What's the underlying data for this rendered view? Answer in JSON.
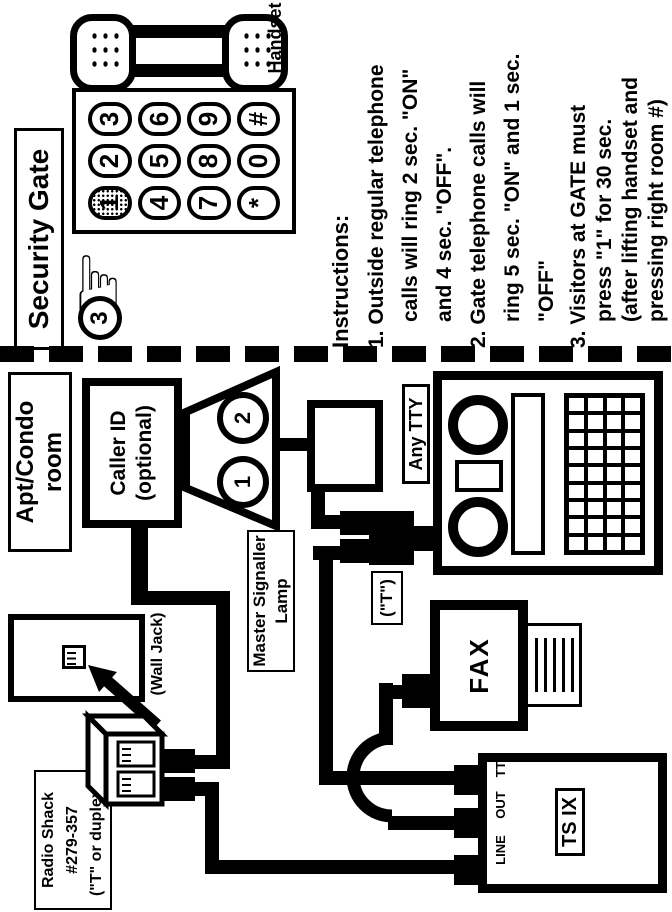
{
  "colors": {
    "ink": "#000000",
    "paper": "#ffffff"
  },
  "gate": {
    "title": "Security Gate",
    "handset_label": "Handset",
    "hand_glyph": "☞",
    "step_badge": "3",
    "keypad_keys": [
      "1",
      "2",
      "3",
      "4",
      "5",
      "6",
      "7",
      "8",
      "9",
      "*",
      "0",
      "#"
    ],
    "instructions": {
      "heading": "Instructions:",
      "items": [
        {
          "lines": [
            "1. Outside regular telephone",
            "calls will ring 2 sec. \"ON\"",
            "and 4 sec. \"OFF\"."
          ]
        },
        {
          "lines": [
            "2. Gate telephone calls will",
            "ring 5 sec. \"ON\" and 1 sec.",
            "\"OFF\""
          ]
        },
        {
          "lines": [
            "3. Visitors at GATE must",
            "press \"1\" for 30 sec.",
            "(after lifting handset and",
            "pressing right room #)"
          ]
        }
      ]
    }
  },
  "room": {
    "title": [
      "Apt/Condo",
      "room"
    ],
    "caller_id": [
      "Caller ID",
      "(optional)"
    ],
    "lamp_circles": [
      "1",
      "2"
    ],
    "master_signaller_label": [
      "Master Signaller",
      "Lamp"
    ],
    "t_label": "(\"T\")",
    "any_tty": "Any TTY",
    "wall_jack": "(Wall Jack)",
    "radio_shack": [
      "Radio Shack",
      "#279-357",
      "(\"T\" or duplex)"
    ],
    "fax": "FAX",
    "tsix": "TS IX",
    "tsix_jacks": [
      "LINE",
      "OUT",
      "TTY"
    ]
  }
}
